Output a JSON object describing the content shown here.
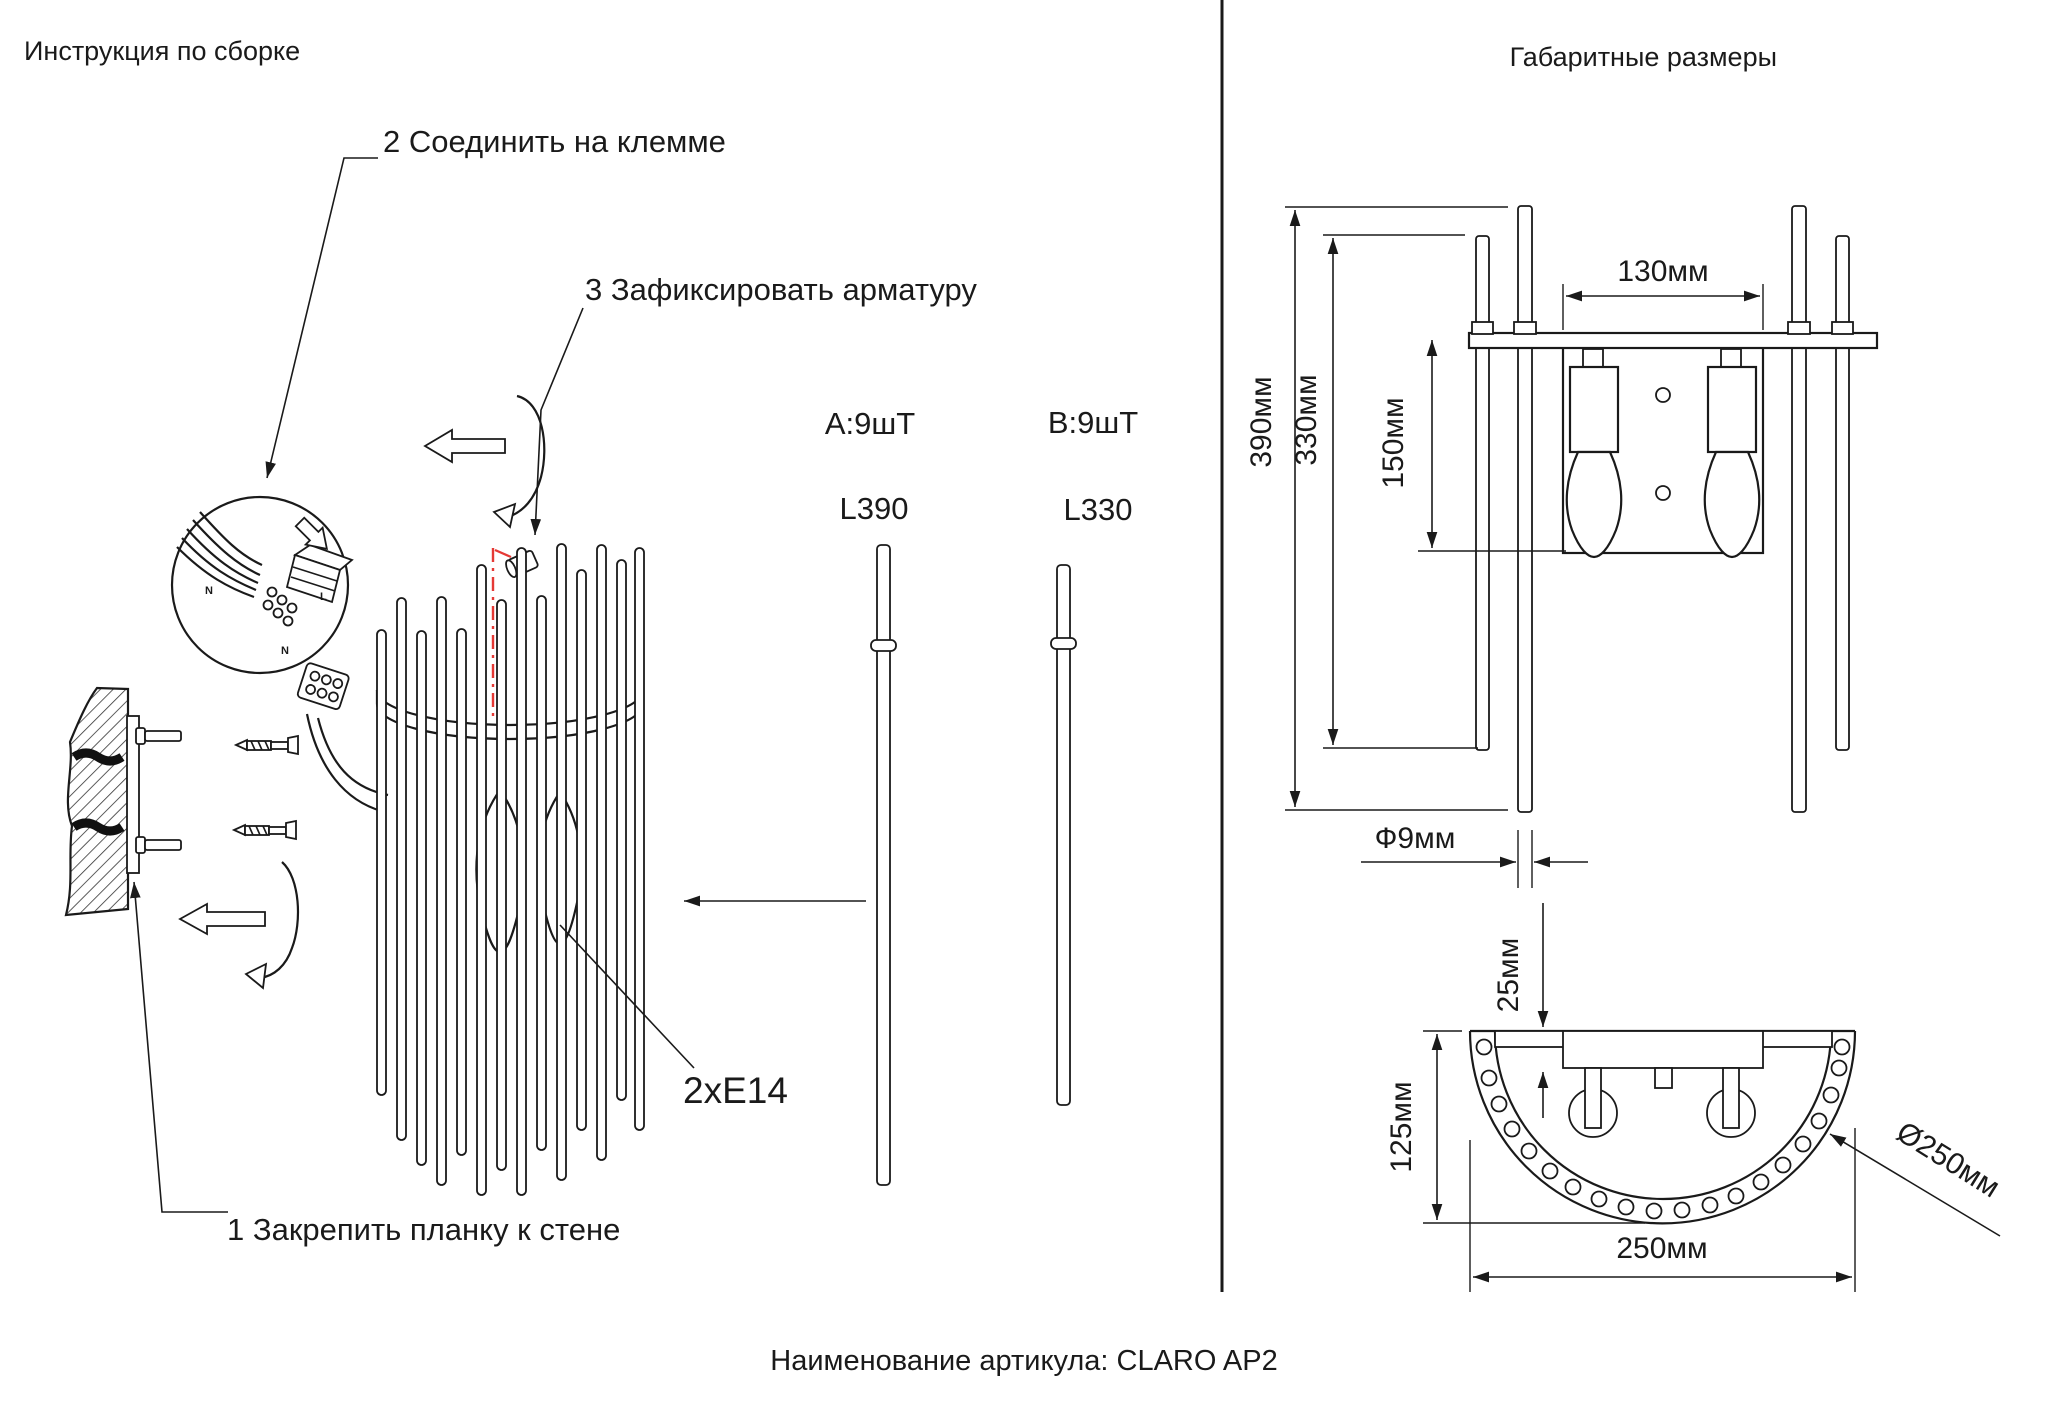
{
  "left": {
    "title": "Инструкция по сборке",
    "step1": "1 Закрепить планку к стене",
    "step2": "2 Соединить на клемме",
    "step3": "3 Зафиксировать арматуру",
    "socket_label": "2хЕ14",
    "parts": {
      "a_qty": "А:9шТ",
      "a_len": "L390",
      "b_qty": "В:9шТ",
      "b_len": "L330"
    },
    "wire_labels": {
      "n1": "N",
      "l": "L",
      "n2": "N"
    }
  },
  "right": {
    "title": "Габаритные размеры",
    "dims": {
      "total_height": "390мм",
      "rod_b_height": "330мм",
      "plate_height": "150мм",
      "plate_width": "130мм",
      "rod_diameter": "Ф9мм",
      "edge_offset": "25мм",
      "depth": "125мм",
      "width": "250мм",
      "shade_diameter": "Ø250мм"
    }
  },
  "footer": {
    "caption": "Наименование артикула: CLARO AP2"
  },
  "colors": {
    "line": "#1a1a1a",
    "accent": "#e53935",
    "wire_blue": "#1565c0",
    "wire_red": "#e53935"
  }
}
